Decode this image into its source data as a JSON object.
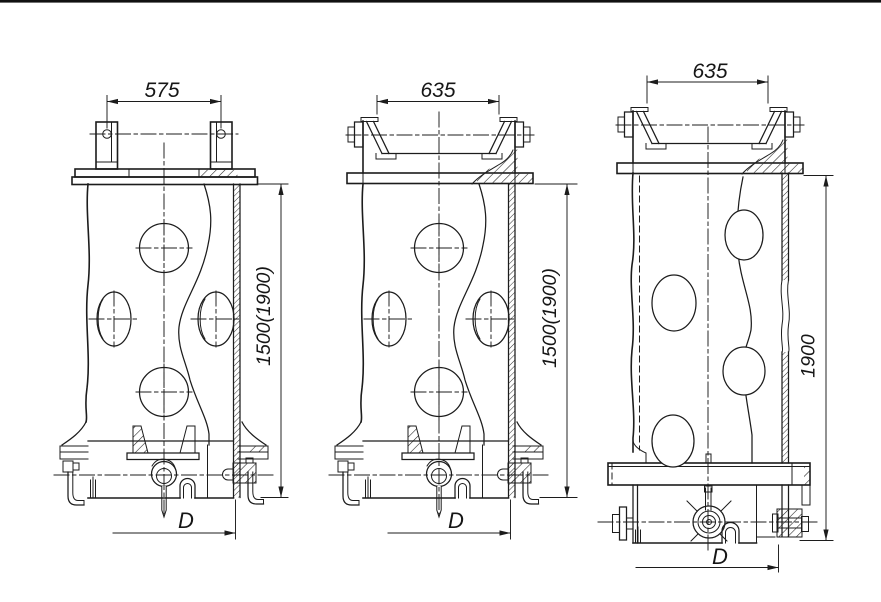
{
  "drawing": {
    "background": "#ffffff",
    "line_color": "#1c1c1c",
    "views": [
      {
        "id": "left-column-with-lifting-lugs",
        "top_width": "575",
        "height": "1500(1900)",
        "base_diameter": "D"
      },
      {
        "id": "middle-column-with-socket-top",
        "top_width": "635",
        "height": "1500(1900)",
        "base_diameter": "D"
      },
      {
        "id": "right-column-with-socket-top",
        "top_width": "635",
        "height": "1900",
        "base_diameter": "D"
      }
    ]
  }
}
